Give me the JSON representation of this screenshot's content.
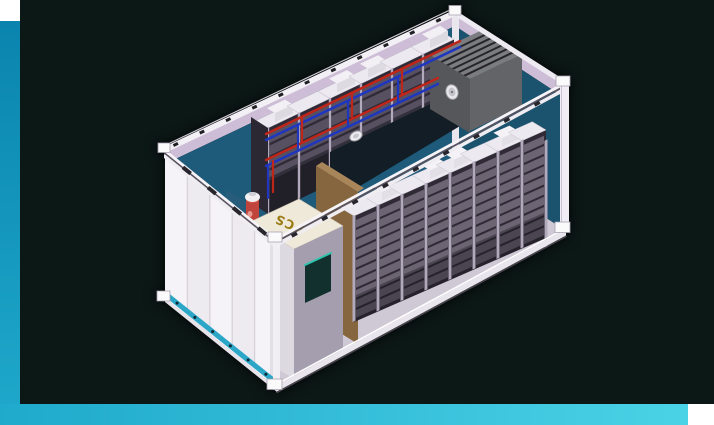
{
  "frame": {
    "background": "#0c1816",
    "accent_top": "#0a84ae",
    "accent_mid": "#1fa9cb",
    "accent_end": "#4ad2e6",
    "corner_block": "#ffffff"
  },
  "scene": {
    "pcs_label": "PCS",
    "racks": {
      "front_bays": 8,
      "front_modules_per_bay": 10,
      "back_bays": 6,
      "back_modules_per_bay": 4,
      "door_panels": 5
    },
    "colors": {
      "container_white": "#f3f1f5",
      "container_lavender": "#cdbdd6",
      "wall_teal": "#1e5a7a",
      "wall_teal_dark": "#1b536f",
      "floor": "#cfc9d6",
      "rack_frame": "#b3a9bd",
      "rack_face": "#2f2a35",
      "module": "#6c6472",
      "module_rear": "#565061",
      "rack_top": "#eceaf0",
      "pipe_red": "#c0251a",
      "pipe_blue": "#1e36c0",
      "hvac_top": "#7b7c80",
      "hvac_body": "#636468",
      "hvac_side": "#56575b",
      "hvac_slat": "#26262a",
      "partition_brown": "#85663f",
      "partition_brown_top": "#a9855a",
      "pcs_top": "#efe9da",
      "pcs_side": "#dcd9e0",
      "pcs_front": "#a59eae",
      "pcs_text": "#9a7c14",
      "pcs_screen": "#12312e",
      "pcs_screen_edge": "#2ec4ad",
      "fire_partition_teal": "#275d7a",
      "extinguisher_red": "#c0443c",
      "base_rail_teal": "#2ba6c6",
      "aisle_shadow": "#131d25"
    }
  }
}
